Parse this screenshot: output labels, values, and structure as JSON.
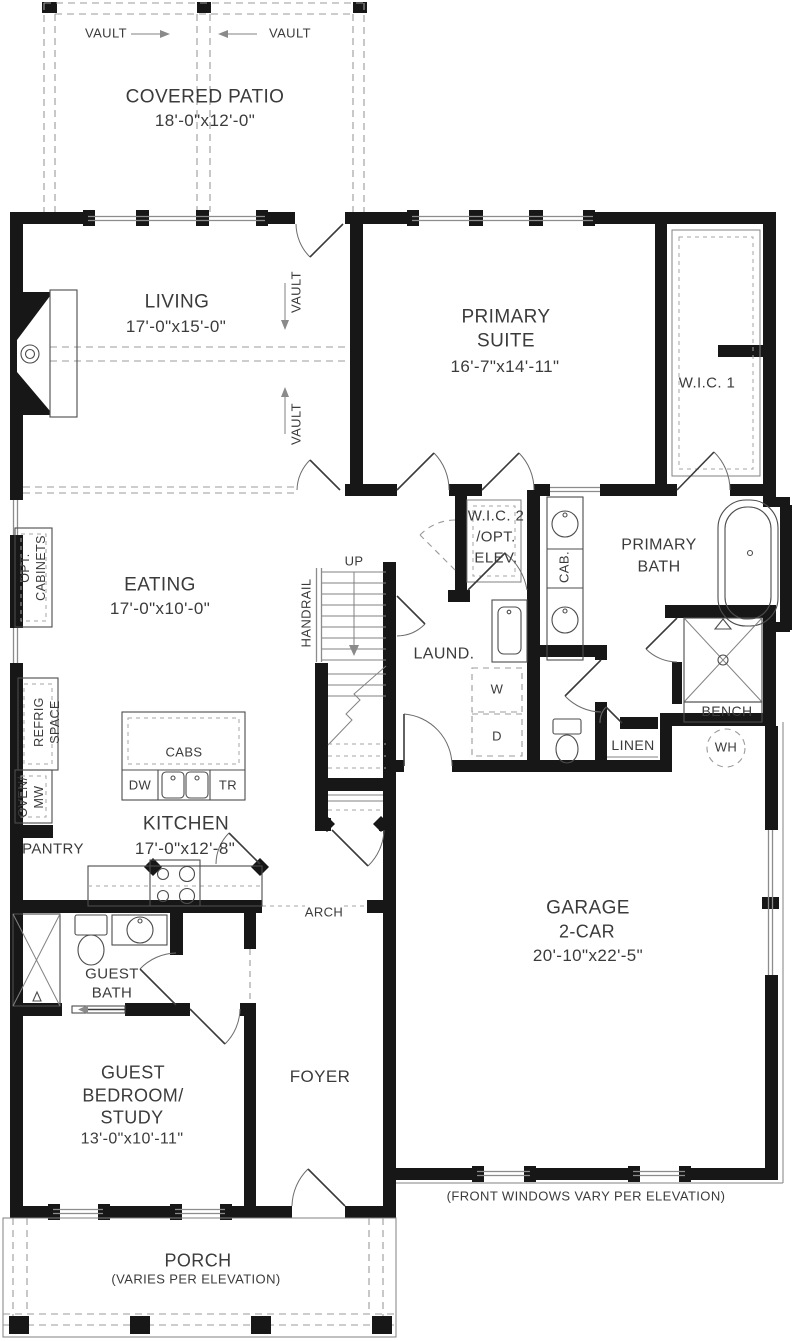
{
  "labels": {
    "vault": "VAULT",
    "covered_patio_title": "COVERED PATIO",
    "covered_patio_dims": "18'-0\"x12'-0\"",
    "living_title": "LIVING",
    "living_dims": "17'-0\"x15'-0\"",
    "primary_suite_l1": "PRIMARY",
    "primary_suite_l2": "SUITE",
    "primary_suite_dims": "16'-7\"x14'-11\"",
    "wic1": "W.I.C. 1",
    "eating_title": "EATING",
    "eating_dims": "17'-0\"x10'-0\"",
    "opt_cabinets_l1": "OPT.",
    "opt_cabinets_l2": "CABINETS",
    "refrig_l1": "REFRIG",
    "refrig_l2": "SPACE",
    "up": "UP",
    "handrail": "HANDRAIL",
    "wic2_l1": "W.I.C. 2",
    "wic2_l2": "/OPT.",
    "wic2_l3": "ELEV.",
    "cab": "CAB.",
    "primary_bath_l1": "PRIMARY",
    "primary_bath_l2": "BATH",
    "laundry": "LAUND.",
    "washer": "W",
    "dryer": "D",
    "linen": "LINEN",
    "bench": "BENCH",
    "water_heater": "WH",
    "cabs": "CABS",
    "dw": "DW",
    "tr": "TR",
    "kitchen_title": "KITCHEN",
    "kitchen_dims": "17'-0\"x12'-8\"",
    "oven_l1": "OVEN/",
    "oven_l2": "MW",
    "pantry": "PANTRY",
    "arch": "ARCH",
    "guest_bath_l1": "GUEST",
    "guest_bath_l2": "BATH",
    "garage_l1": "GARAGE",
    "garage_l2": "2-CAR",
    "garage_dims": "20'-10\"x22'-5\"",
    "guest_bed_l1": "GUEST",
    "guest_bed_l2": "BEDROOM/",
    "guest_bed_l3": "STUDY",
    "guest_bed_dims": "13'-0\"x10'-11\"",
    "foyer": "FOYER",
    "front_windows_note": "(FRONT WINDOWS VARY PER ELEVATION)",
    "porch_title": "PORCH",
    "porch_note": "(VARIES PER ELEVATION)"
  },
  "colors": {
    "wall": "#171717",
    "line": "#4c4c4c",
    "dashed": "#9b9b9b",
    "text": "#3b3b3b",
    "background": "#ffffff"
  }
}
